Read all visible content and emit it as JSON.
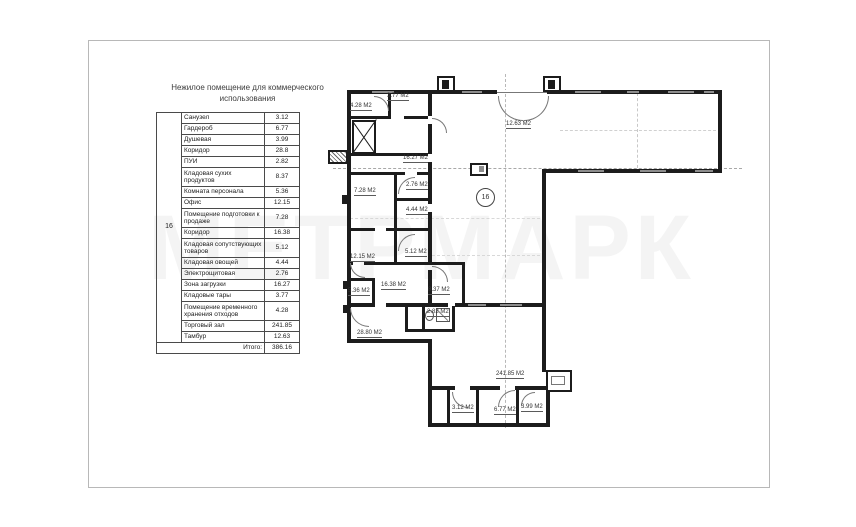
{
  "title": {
    "line1": "Нежилое помещение для коммерческого",
    "line2": "использования"
  },
  "watermark": "МЕТРМАРК",
  "legend": {
    "unit_number": "16",
    "rows": [
      {
        "name": "Санузел",
        "area": "3.12"
      },
      {
        "name": "Гардероб",
        "area": "6.77"
      },
      {
        "name": "Душевая",
        "area": "3.99"
      },
      {
        "name": "Коридор",
        "area": "28.8"
      },
      {
        "name": "ПУИ",
        "area": "2.82"
      },
      {
        "name": "Кладовая сухих продуктов",
        "area": "8.37"
      },
      {
        "name": "Комната персонала",
        "area": "5.36"
      },
      {
        "name": "Офис",
        "area": "12.15"
      },
      {
        "name": "Помещение подготовки к продаже",
        "area": "7.28"
      },
      {
        "name": "Коридор",
        "area": "16.38"
      },
      {
        "name": "Кладовая сопутствующих товаров",
        "area": "5.12"
      },
      {
        "name": "Кладовая овощей",
        "area": "4.44"
      },
      {
        "name": "Электрощитовая",
        "area": "2.76"
      },
      {
        "name": "Зона загрузки",
        "area": "16.27"
      },
      {
        "name": "Кладовые тары",
        "area": "3.77"
      },
      {
        "name": "Помещение временного хранения отходов",
        "area": "4.28"
      },
      {
        "name": "Торговый зал",
        "area": "241.85"
      },
      {
        "name": "Тамбур",
        "area": "12.63"
      }
    ],
    "total_label": "Итого:",
    "total_area": "386.16"
  },
  "plan": {
    "unit_circle": "16",
    "area_labels": [
      "4.28 М2",
      "3.77 М2",
      "12.63 М2",
      "16.27 М2",
      "2.76 М2",
      "7.28 М2",
      "4.44 М2",
      "12.15 М2",
      "5.12 М2",
      "5.36 М2",
      "16.38 М2",
      "8.37 М2",
      "2.82 М2",
      "28.80 М2",
      "241.85 М2",
      "3.12 М2",
      "6.77 М2",
      "3.99 М2"
    ]
  }
}
